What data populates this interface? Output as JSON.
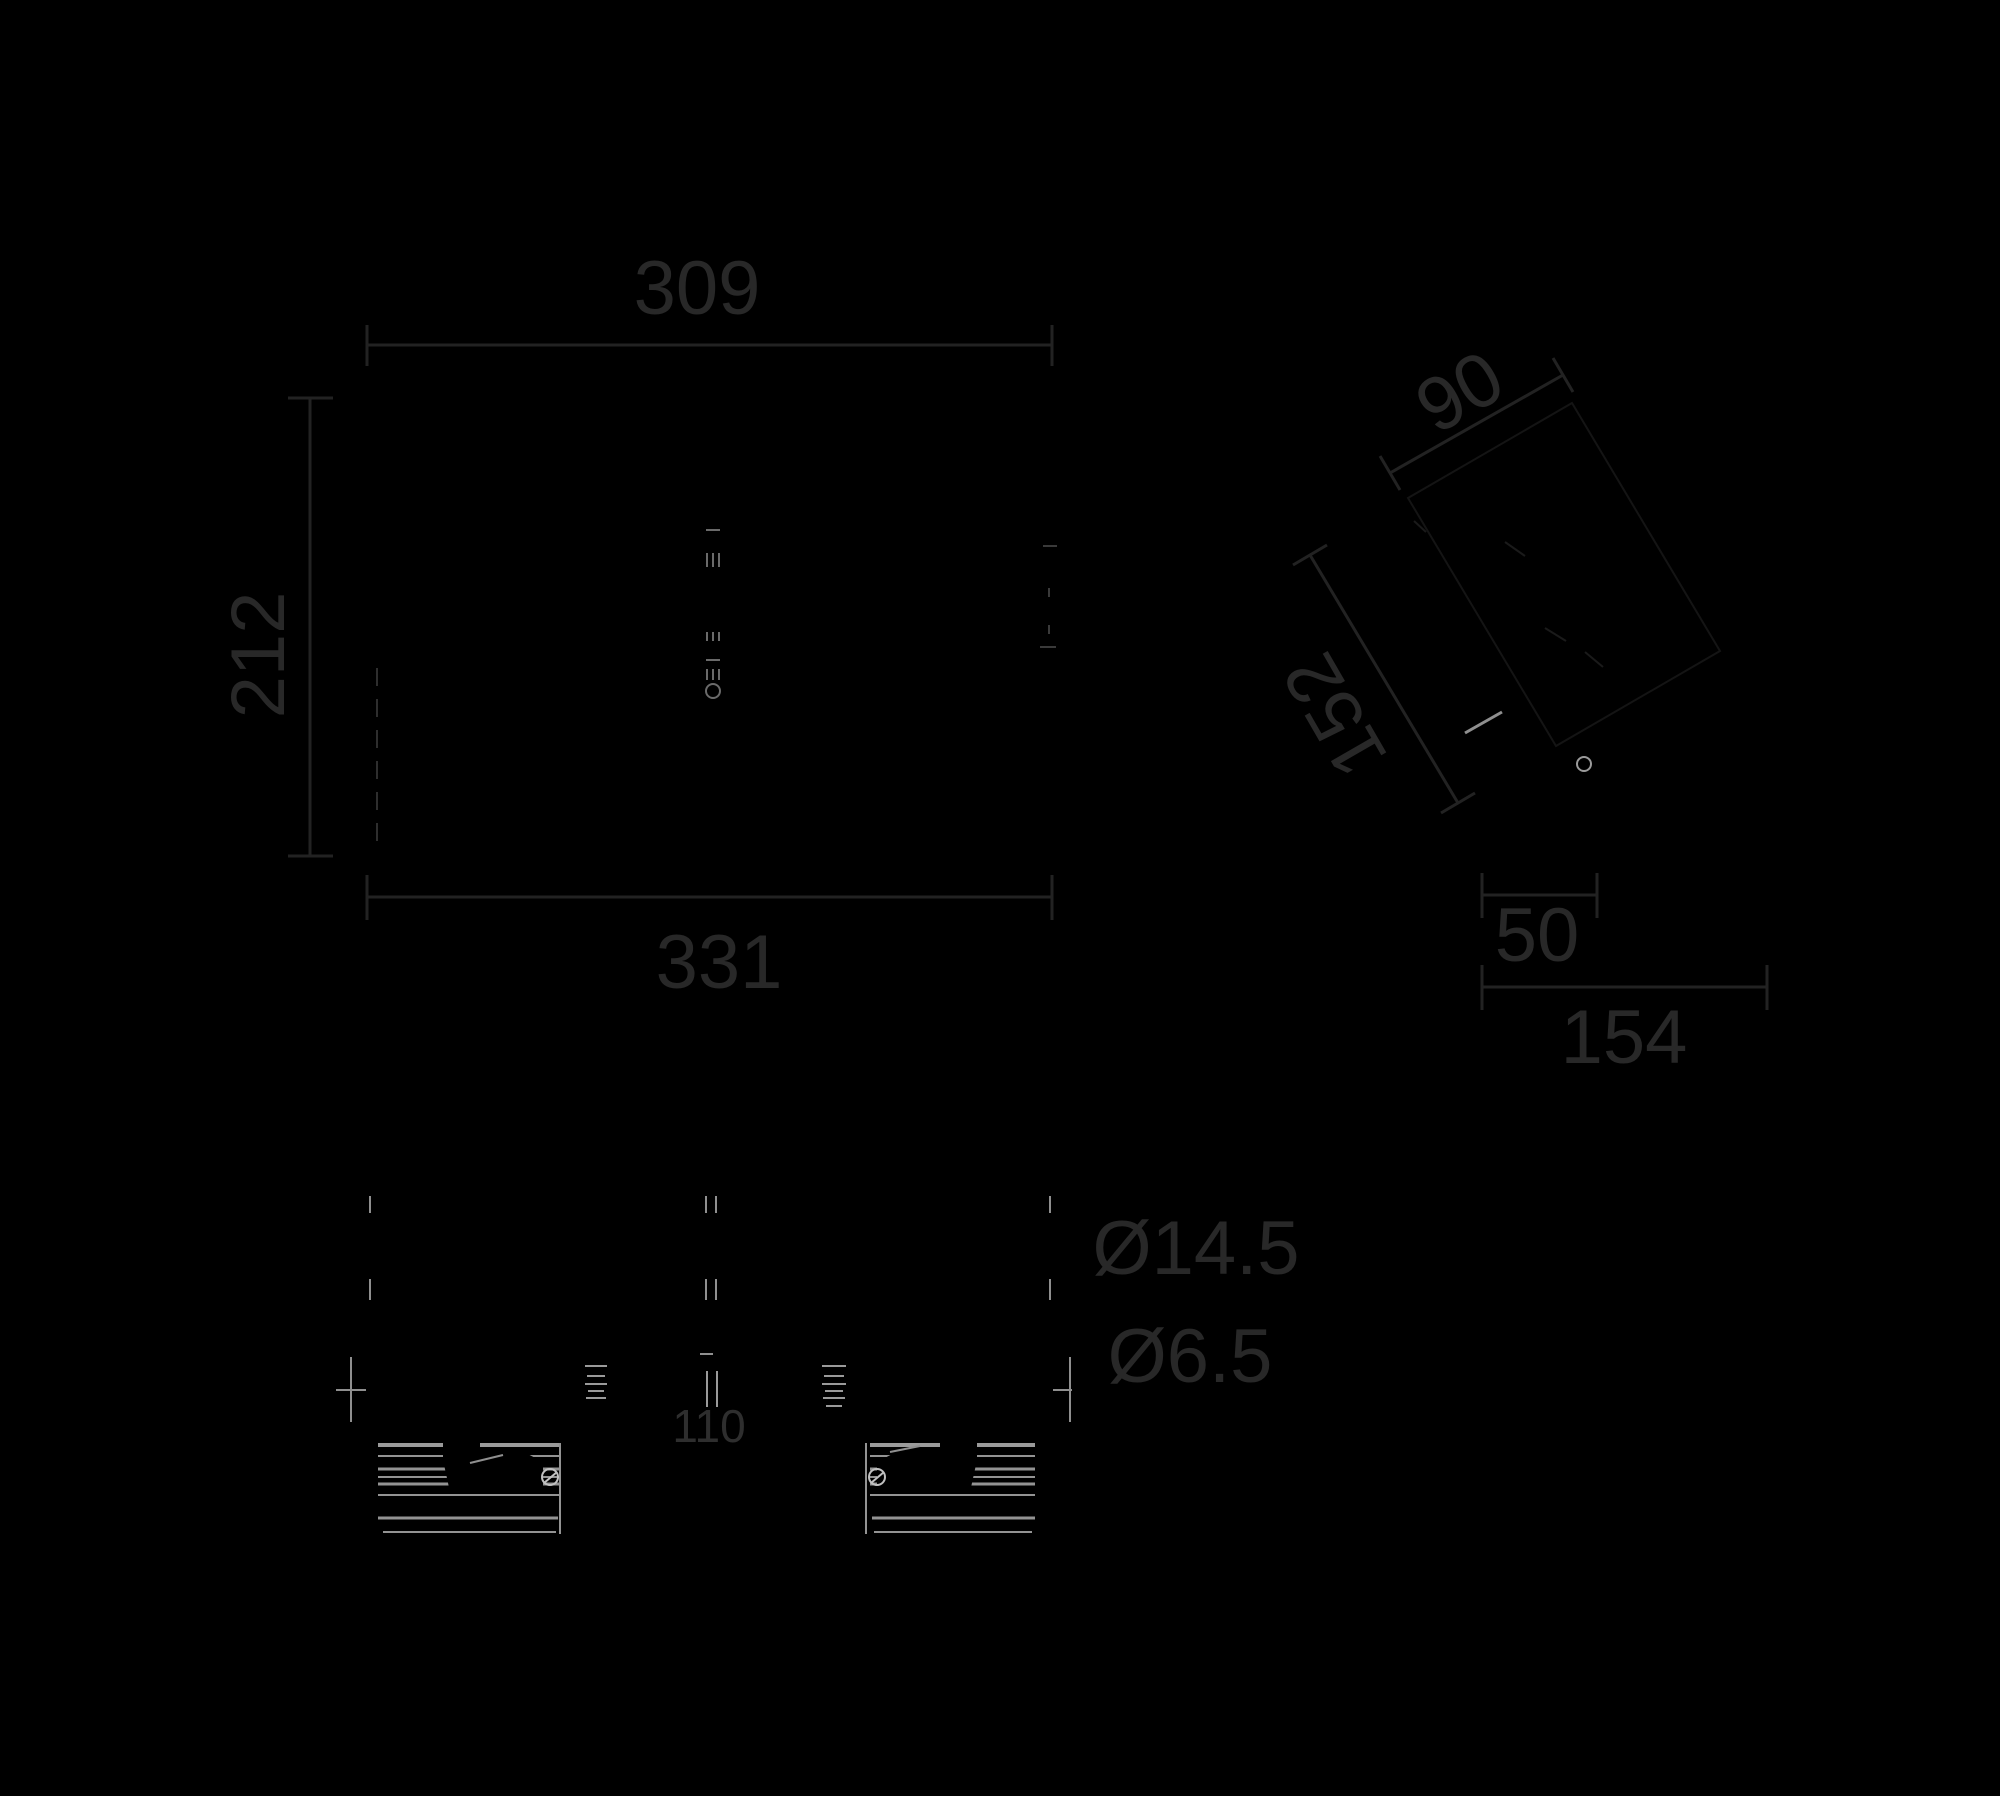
{
  "drawing": {
    "width": 2000,
    "height": 1796,
    "background": "#000000",
    "colors": {
      "dim": "#222222",
      "text": "#282828",
      "text_small": "#2e2e2e",
      "bright": "#8f8f8f",
      "bright2": "#9a9a9a",
      "strip": "#939393",
      "circle": "#c0c0c0",
      "faint": "#1a1a1a",
      "hintpoly": "#141414",
      "center_detail": "#6a6a6a",
      "edge_dash": "#2e2e2e",
      "edge_faint": "#3a3a3a"
    },
    "labels": [
      {
        "name": "dim-front-top-width-label",
        "text": "309",
        "x": 697,
        "y": 287,
        "size": 76,
        "rot": 0,
        "color": "#282828"
      },
      {
        "name": "dim-front-height-label",
        "text": "212",
        "x": 257,
        "y": 655,
        "size": 76,
        "rot": -90,
        "color": "#282828"
      },
      {
        "name": "dim-front-bottom-width-label",
        "text": "331",
        "x": 719,
        "y": 961,
        "size": 76,
        "rot": 0,
        "color": "#282828"
      },
      {
        "name": "dim-side-depth-label",
        "text": "90",
        "x": 1459,
        "y": 391,
        "size": 76,
        "rot": -30,
        "color": "#282828"
      },
      {
        "name": "dim-side-height-label",
        "text": "152",
        "x": 1334,
        "y": 716,
        "size": 76,
        "rot": -120,
        "color": "#282828"
      },
      {
        "name": "dim-side-offset-label",
        "text": "50",
        "x": 1537,
        "y": 934,
        "size": 76,
        "rot": 0,
        "color": "#282828"
      },
      {
        "name": "dim-side-total-depth-label",
        "text": "154",
        "x": 1624,
        "y": 1036,
        "size": 76,
        "rot": 0,
        "color": "#282828"
      },
      {
        "name": "hole-diameter-large-label",
        "text": "Ø14.5",
        "x": 1196,
        "y": 1247,
        "size": 76,
        "rot": 0,
        "color": "#282828"
      },
      {
        "name": "hole-diameter-small-label",
        "text": "Ø6.5",
        "x": 1190,
        "y": 1355,
        "size": 76,
        "rot": 0,
        "color": "#282828"
      },
      {
        "name": "dim-hole-spacing-label",
        "text": "110",
        "x": 709,
        "y": 1425,
        "size": 46,
        "rot": 0,
        "color": "#2e2e2e"
      }
    ],
    "dim_lines": [
      {
        "x1": 367,
        "y1": 345,
        "x2": 1052,
        "y2": 345
      },
      {
        "x1": 367,
        "y1": 325,
        "x2": 367,
        "y2": 366
      },
      {
        "x1": 1052,
        "y1": 325,
        "x2": 1052,
        "y2": 366
      },
      {
        "x1": 310,
        "y1": 398,
        "x2": 310,
        "y2": 856
      },
      {
        "x1": 288,
        "y1": 398,
        "x2": 333,
        "y2": 398
      },
      {
        "x1": 288,
        "y1": 856,
        "x2": 333,
        "y2": 856
      },
      {
        "x1": 367,
        "y1": 897,
        "x2": 1052,
        "y2": 897
      },
      {
        "x1": 367,
        "y1": 875,
        "x2": 367,
        "y2": 920
      },
      {
        "x1": 1052,
        "y1": 875,
        "x2": 1052,
        "y2": 920
      },
      {
        "x1": 1390,
        "y1": 473,
        "x2": 1563,
        "y2": 375
      },
      {
        "x1": 1380,
        "y1": 456,
        "x2": 1400,
        "y2": 490
      },
      {
        "x1": 1553,
        "y1": 358,
        "x2": 1573,
        "y2": 392
      },
      {
        "x1": 1310,
        "y1": 555,
        "x2": 1458,
        "y2": 803
      },
      {
        "x1": 1293,
        "y1": 565,
        "x2": 1327,
        "y2": 545
      },
      {
        "x1": 1441,
        "y1": 813,
        "x2": 1475,
        "y2": 793
      },
      {
        "x1": 1482,
        "y1": 895,
        "x2": 1597,
        "y2": 895
      },
      {
        "x1": 1482,
        "y1": 873,
        "x2": 1482,
        "y2": 918
      },
      {
        "x1": 1597,
        "y1": 873,
        "x2": 1597,
        "y2": 918
      },
      {
        "x1": 1482,
        "y1": 987,
        "x2": 1767,
        "y2": 987
      },
      {
        "x1": 1482,
        "y1": 965,
        "x2": 1482,
        "y2": 1010
      },
      {
        "x1": 1767,
        "y1": 965,
        "x2": 1767,
        "y2": 1010
      }
    ],
    "detail_lines": [
      {
        "x1": 706,
        "y1": 530,
        "x2": 720,
        "y2": 530,
        "c": "center_detail",
        "w": 2
      },
      {
        "x1": 707,
        "y1": 553,
        "x2": 707,
        "y2": 567,
        "c": "center_detail",
        "w": 2
      },
      {
        "x1": 713,
        "y1": 553,
        "x2": 713,
        "y2": 567,
        "c": "center_detail",
        "w": 2
      },
      {
        "x1": 719,
        "y1": 553,
        "x2": 719,
        "y2": 567,
        "c": "center_detail",
        "w": 2
      },
      {
        "x1": 707,
        "y1": 632,
        "x2": 707,
        "y2": 641,
        "c": "center_detail",
        "w": 2
      },
      {
        "x1": 713,
        "y1": 632,
        "x2": 713,
        "y2": 641,
        "c": "center_detail",
        "w": 2
      },
      {
        "x1": 719,
        "y1": 632,
        "x2": 719,
        "y2": 641,
        "c": "center_detail",
        "w": 2
      },
      {
        "x1": 706,
        "y1": 660,
        "x2": 720,
        "y2": 660,
        "c": "center_detail",
        "w": 2
      },
      {
        "x1": 707,
        "y1": 669,
        "x2": 707,
        "y2": 680,
        "c": "center_detail",
        "w": 2
      },
      {
        "x1": 713,
        "y1": 669,
        "x2": 713,
        "y2": 680,
        "c": "center_detail",
        "w": 2
      },
      {
        "x1": 719,
        "y1": 669,
        "x2": 719,
        "y2": 680,
        "c": "center_detail",
        "w": 2
      },
      {
        "x1": 377,
        "y1": 668,
        "x2": 377,
        "y2": 852,
        "c": "edge_dash",
        "w": 2,
        "dash": "18 13"
      },
      {
        "x1": 1043,
        "y1": 546,
        "x2": 1057,
        "y2": 546,
        "c": "edge_faint",
        "w": 2
      },
      {
        "x1": 1049,
        "y1": 588,
        "x2": 1049,
        "y2": 597,
        "c": "edge_faint",
        "w": 2
      },
      {
        "x1": 1049,
        "y1": 625,
        "x2": 1049,
        "y2": 634,
        "c": "edge_faint",
        "w": 2
      },
      {
        "x1": 1040,
        "y1": 647,
        "x2": 1056,
        "y2": 647,
        "c": "edge_faint",
        "w": 2
      },
      {
        "x1": 1505,
        "y1": 542,
        "x2": 1525,
        "y2": 556,
        "c": "faint",
        "w": 2
      },
      {
        "x1": 1545,
        "y1": 628,
        "x2": 1566,
        "y2": 641,
        "c": "faint",
        "w": 2
      },
      {
        "x1": 1585,
        "y1": 652,
        "x2": 1603,
        "y2": 667,
        "c": "faint",
        "w": 2
      },
      {
        "x1": 1414,
        "y1": 521,
        "x2": 1426,
        "y2": 532,
        "c": "faint",
        "w": 2
      },
      {
        "x1": 1465,
        "y1": 733,
        "x2": 1502,
        "y2": 712,
        "c": "bright",
        "w": 3
      },
      {
        "x1": 370,
        "y1": 1196,
        "x2": 370,
        "y2": 1213,
        "c": "bright",
        "w": 2
      },
      {
        "x1": 370,
        "y1": 1279,
        "x2": 370,
        "y2": 1300,
        "c": "bright",
        "w": 2
      },
      {
        "x1": 1050,
        "y1": 1196,
        "x2": 1050,
        "y2": 1213,
        "c": "bright",
        "w": 2
      },
      {
        "x1": 1050,
        "y1": 1279,
        "x2": 1050,
        "y2": 1300,
        "c": "bright",
        "w": 2
      },
      {
        "x1": 706,
        "y1": 1196,
        "x2": 706,
        "y2": 1213,
        "c": "bright",
        "w": 2
      },
      {
        "x1": 716,
        "y1": 1196,
        "x2": 716,
        "y2": 1213,
        "c": "bright",
        "w": 2
      },
      {
        "x1": 706,
        "y1": 1279,
        "x2": 706,
        "y2": 1300,
        "c": "bright",
        "w": 2
      },
      {
        "x1": 716,
        "y1": 1279,
        "x2": 716,
        "y2": 1300,
        "c": "bright",
        "w": 2
      },
      {
        "x1": 700,
        "y1": 1354,
        "x2": 713,
        "y2": 1354,
        "c": "bright",
        "w": 2
      },
      {
        "x1": 707,
        "y1": 1371,
        "x2": 707,
        "y2": 1407,
        "c": "bright2",
        "w": 2
      },
      {
        "x1": 717,
        "y1": 1371,
        "x2": 717,
        "y2": 1407,
        "c": "bright2",
        "w": 2
      },
      {
        "x1": 585,
        "y1": 1366,
        "x2": 607,
        "y2": 1366,
        "c": "bright2",
        "w": 2
      },
      {
        "x1": 587,
        "y1": 1376,
        "x2": 605,
        "y2": 1376,
        "c": "bright2",
        "w": 2
      },
      {
        "x1": 585,
        "y1": 1384,
        "x2": 607,
        "y2": 1384,
        "c": "bright2",
        "w": 2
      },
      {
        "x1": 588,
        "y1": 1391,
        "x2": 604,
        "y2": 1391,
        "c": "bright2",
        "w": 2
      },
      {
        "x1": 586,
        "y1": 1398,
        "x2": 606,
        "y2": 1398,
        "c": "bright2",
        "w": 2
      },
      {
        "x1": 822,
        "y1": 1366,
        "x2": 846,
        "y2": 1366,
        "c": "bright2",
        "w": 2
      },
      {
        "x1": 824,
        "y1": 1376,
        "x2": 844,
        "y2": 1376,
        "c": "bright2",
        "w": 2
      },
      {
        "x1": 822,
        "y1": 1384,
        "x2": 846,
        "y2": 1384,
        "c": "bright2",
        "w": 2
      },
      {
        "x1": 825,
        "y1": 1391,
        "x2": 843,
        "y2": 1391,
        "c": "bright2",
        "w": 2
      },
      {
        "x1": 823,
        "y1": 1398,
        "x2": 845,
        "y2": 1398,
        "c": "bright2",
        "w": 2
      },
      {
        "x1": 826,
        "y1": 1406,
        "x2": 842,
        "y2": 1406,
        "c": "bright2",
        "w": 2
      },
      {
        "x1": 351,
        "y1": 1357,
        "x2": 351,
        "y2": 1422,
        "c": "bright",
        "w": 2
      },
      {
        "x1": 336,
        "y1": 1390,
        "x2": 366,
        "y2": 1390,
        "c": "bright",
        "w": 2
      },
      {
        "x1": 1070,
        "y1": 1357,
        "x2": 1070,
        "y2": 1422,
        "c": "bright",
        "w": 2
      },
      {
        "x1": 1053,
        "y1": 1390,
        "x2": 1072,
        "y2": 1390,
        "c": "bright",
        "w": 2
      }
    ],
    "strip_lines": [
      {
        "x1": 378,
        "y1": 1445,
        "x2": 560,
        "y2": 1445,
        "c": "bright2",
        "w": 4
      },
      {
        "x1": 378,
        "y1": 1456,
        "x2": 560,
        "y2": 1456,
        "c": "strip",
        "w": 2
      },
      {
        "x1": 378,
        "y1": 1469,
        "x2": 560,
        "y2": 1469,
        "c": "strip",
        "w": 3
      },
      {
        "x1": 378,
        "y1": 1477,
        "x2": 560,
        "y2": 1477,
        "c": "strip",
        "w": 2
      },
      {
        "x1": 378,
        "y1": 1484,
        "x2": 560,
        "y2": 1484,
        "c": "strip",
        "w": 3
      },
      {
        "x1": 378,
        "y1": 1495,
        "x2": 560,
        "y2": 1495,
        "c": "strip",
        "w": 2
      },
      {
        "x1": 378,
        "y1": 1518,
        "x2": 558,
        "y2": 1518,
        "c": "strip",
        "w": 3
      },
      {
        "x1": 383,
        "y1": 1532,
        "x2": 556,
        "y2": 1532,
        "c": "strip",
        "w": 2
      },
      {
        "x1": 560,
        "y1": 1443,
        "x2": 560,
        "y2": 1534,
        "c": "strip",
        "w": 2
      },
      {
        "x1": 870,
        "y1": 1445,
        "x2": 1035,
        "y2": 1445,
        "c": "bright2",
        "w": 4
      },
      {
        "x1": 870,
        "y1": 1456,
        "x2": 1035,
        "y2": 1456,
        "c": "strip",
        "w": 2
      },
      {
        "x1": 870,
        "y1": 1469,
        "x2": 1035,
        "y2": 1469,
        "c": "strip",
        "w": 3
      },
      {
        "x1": 870,
        "y1": 1477,
        "x2": 1035,
        "y2": 1477,
        "c": "strip",
        "w": 2
      },
      {
        "x1": 870,
        "y1": 1484,
        "x2": 1035,
        "y2": 1484,
        "c": "strip",
        "w": 3
      },
      {
        "x1": 870,
        "y1": 1495,
        "x2": 1035,
        "y2": 1495,
        "c": "strip",
        "w": 2
      },
      {
        "x1": 872,
        "y1": 1518,
        "x2": 1035,
        "y2": 1518,
        "c": "strip",
        "w": 3
      },
      {
        "x1": 874,
        "y1": 1532,
        "x2": 1032,
        "y2": 1532,
        "c": "strip",
        "w": 2
      },
      {
        "x1": 866,
        "y1": 1443,
        "x2": 866,
        "y2": 1534,
        "c": "strip",
        "w": 2
      }
    ],
    "blobs": [
      {
        "d": "M443,1441 L480,1441 L480,1450 L520,1450 L543,1462 L543,1492 L450,1492 L443,1460 Z"
      },
      {
        "d": "M977,1441 L940,1441 L940,1450 L900,1450 L877,1462 L877,1492 L970,1492 L977,1460 Z"
      }
    ],
    "fragments": [
      {
        "x1": 470,
        "y1": 1463,
        "x2": 503,
        "y2": 1455,
        "c": "bright",
        "w": 2
      },
      {
        "x1": 890,
        "y1": 1452,
        "x2": 920,
        "y2": 1446,
        "c": "bright",
        "w": 2
      },
      {
        "x1": 544,
        "y1": 1483,
        "x2": 557,
        "y2": 1472,
        "c": "circle",
        "w": 2
      },
      {
        "x1": 871,
        "y1": 1483,
        "x2": 884,
        "y2": 1472,
        "c": "circle",
        "w": 2
      }
    ],
    "circles": [
      {
        "cx": 713,
        "cy": 691,
        "r": 7,
        "c": "center_detail",
        "w": 2
      },
      {
        "cx": 1584,
        "cy": 764,
        "r": 7,
        "c": "bright2",
        "w": 2
      },
      {
        "cx": 550,
        "cy": 1477,
        "r": 8,
        "c": "circle",
        "w": 2
      },
      {
        "cx": 877,
        "cy": 1477,
        "r": 8,
        "c": "circle",
        "w": 2
      }
    ],
    "polygons": [
      {
        "points": "1408,498 1572,403 1720,651 1556,746",
        "c": "hintpoly",
        "w": 2
      }
    ]
  }
}
